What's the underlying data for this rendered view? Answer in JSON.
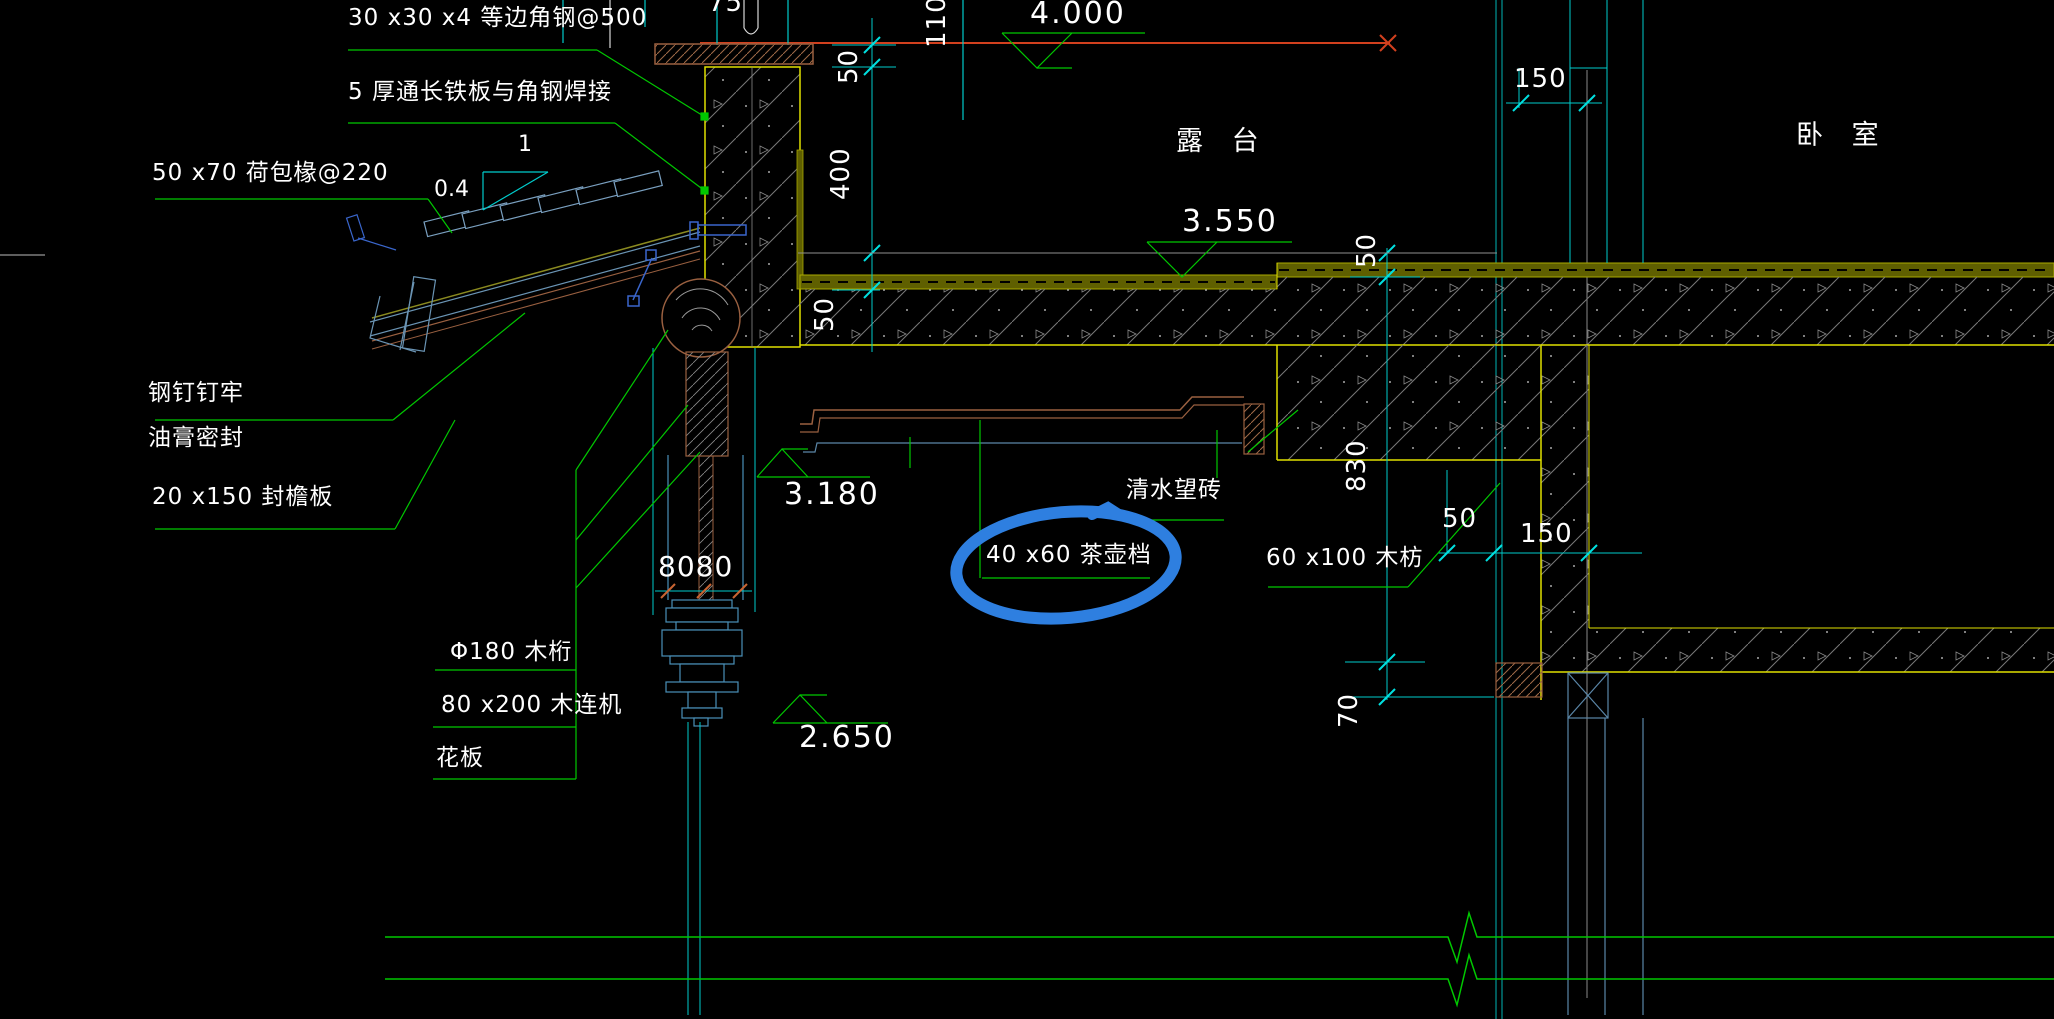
{
  "drawing": {
    "callouts": {
      "steel_angle": "30 x30 x4 等边角钢@500",
      "iron_plate": "5 厚通长铁板与角钢焊接",
      "rafter": "50 x70 荷包椽@220",
      "nail": "钢钉钉牢",
      "sealant": "油膏密封",
      "fascia_board": "20 x150 封檐板",
      "purlin": "Φ180 木桁",
      "connector": "80 x200 木连机",
      "flower_board": "花板",
      "brick_layer": "清水望砖",
      "teapot_batten": "40 x60 茶壶档",
      "wood_batten": "60 x100 木枋"
    },
    "rooms": {
      "terrace": "露 台",
      "bedroom": "卧 室"
    },
    "elevations": {
      "e4000": "4.000",
      "e3550": "3.550",
      "e3180": "3.180",
      "e2650": "2.650"
    },
    "dimensions": {
      "d75": "75",
      "d110": "110",
      "d50_top": "50",
      "d400": "400",
      "d50_slab": "50",
      "d150_top": "150",
      "d50_right": "50",
      "d830": "830",
      "d70": "70",
      "d50_bottom": "50",
      "d150_bottom": "150",
      "d8080": "8080"
    },
    "slope": {
      "run": "1",
      "rise": "0.4"
    },
    "colors": {
      "leader_green": "#00c800",
      "dimension_cyan": "#00cccc",
      "outline_yellow": "#e0e000",
      "level_red": "#d2401e",
      "marker_blue": "#2e7fe0",
      "wood_brown": "#9a6040"
    }
  }
}
